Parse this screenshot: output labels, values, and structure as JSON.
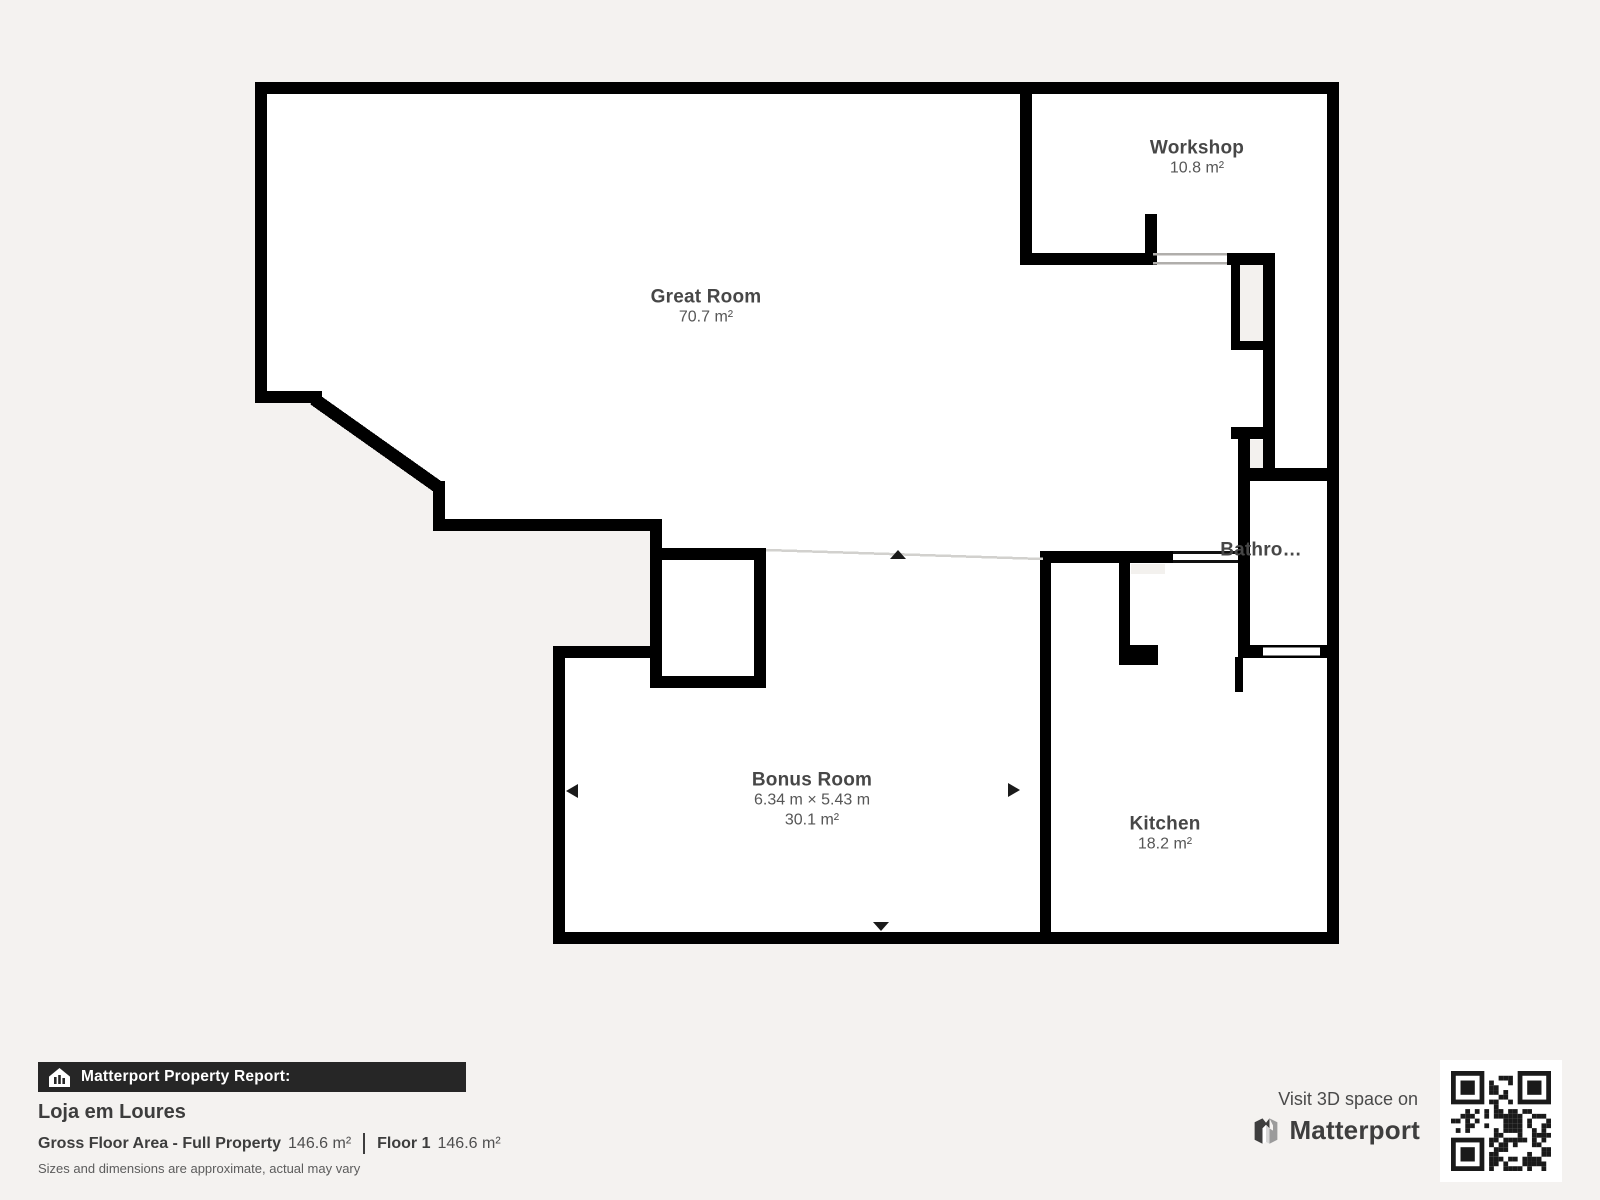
{
  "floor_plan": {
    "rooms": [
      {
        "name": "Great Room",
        "area": "70.7 m²"
      },
      {
        "name": "Workshop",
        "area": "10.8 m²"
      },
      {
        "name": "Bathroom",
        "display_name": "Bathro…"
      },
      {
        "name": "Bonus Room",
        "dimensions": "6.34 m × 5.43 m",
        "area": "30.1 m²"
      },
      {
        "name": "Kitchen",
        "area": "18.2 m²"
      }
    ],
    "colors": {
      "wall": "#000000",
      "floor": "#ffffff",
      "background": "#f4f2f0",
      "label_text": "#474747"
    }
  },
  "report": {
    "bar_label": "Matterport Property Report:",
    "property_name": "Loja em Loures",
    "gross_label": "Gross Floor Area - Full Property",
    "gross_value": "146.6 m²",
    "floor_label": "Floor 1",
    "floor_value": "146.6 m²",
    "disclaimer": "Sizes and dimensions are approximate, actual may vary"
  },
  "cta": {
    "visit_text": "Visit 3D space on",
    "brand": "Matterport"
  }
}
